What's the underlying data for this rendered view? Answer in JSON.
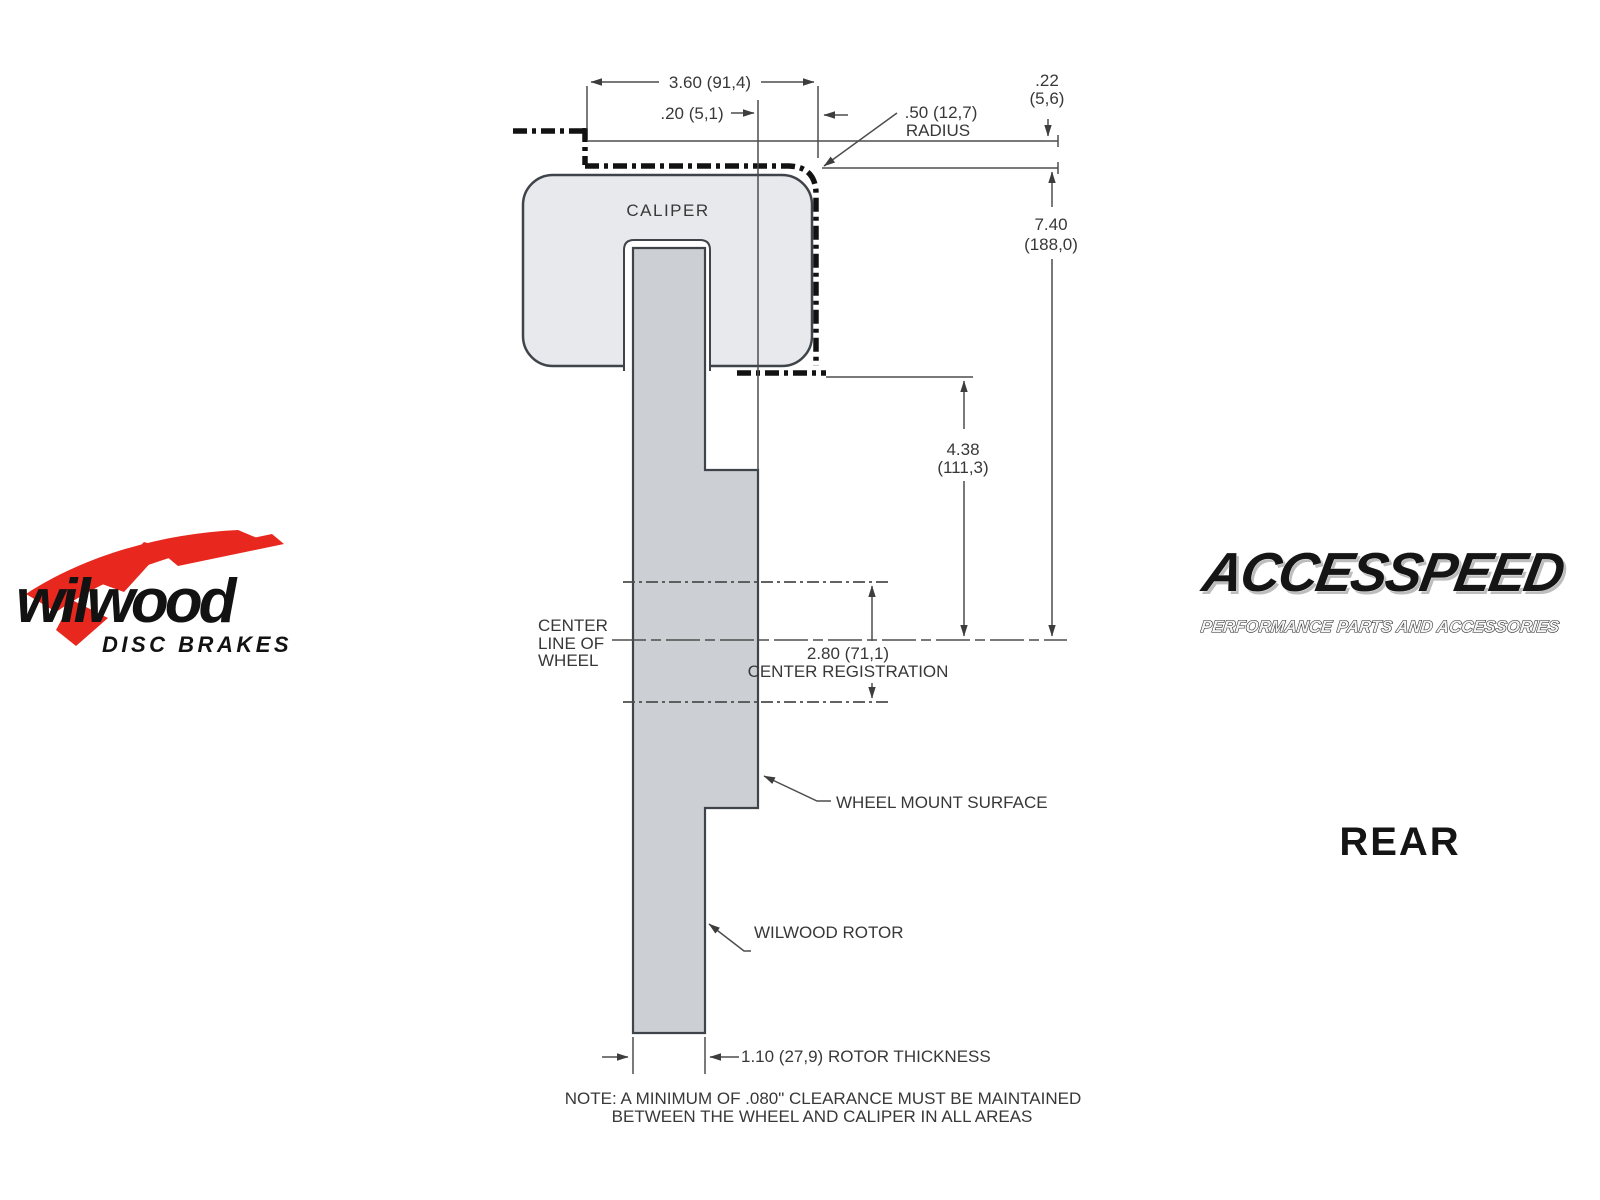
{
  "drawing": {
    "caliper_label": "CALIPER",
    "dim_caliper_width": "3.60 (91,4)",
    "dim_offset": ".20 (5,1)",
    "dim_radius_value": ".50 (12,7)",
    "dim_radius_word": "RADIUS",
    "dim_gap_value": ".22",
    "dim_gap_metric": "(5,6)",
    "dim_overall_value": "7.40",
    "dim_overall_metric": "(188,0)",
    "dim_caliper_to_cl_value": "4.38",
    "dim_caliper_to_cl_metric": "(111,3)",
    "centerline_label_1": "CENTER",
    "centerline_label_2": "LINE OF",
    "centerline_label_3": "WHEEL",
    "dim_center_reg_value": "2.80 (71,1)",
    "center_reg_label": "CENTER REGISTRATION",
    "wheel_mount_label": "WHEEL MOUNT SURFACE",
    "rotor_label": "WILWOOD ROTOR",
    "dim_rotor_thickness": "1.10 (27,9) ROTOR THICKNESS",
    "note_line1": "NOTE: A MINIMUM OF .080\" CLEARANCE MUST BE MAINTAINED",
    "note_line2": "BETWEEN THE WHEEL AND CALIPER IN ALL AREAS",
    "colors": {
      "caliper_fill": "#e7e9ed",
      "rotor_fill": "#ccd0d5",
      "line_thin": "#4d4d4d",
      "line_phantom": "#121212"
    }
  },
  "branding": {
    "wilwood_name": "wilwood",
    "wilwood_tagline": "DISC BRAKES",
    "wilwood_red": "#e8281e",
    "accesspeed_name": "ACCESSPEED",
    "accesspeed_tagline": "PERFORMANCE PARTS AND ACCESSORIES"
  },
  "view_label": "REAR"
}
